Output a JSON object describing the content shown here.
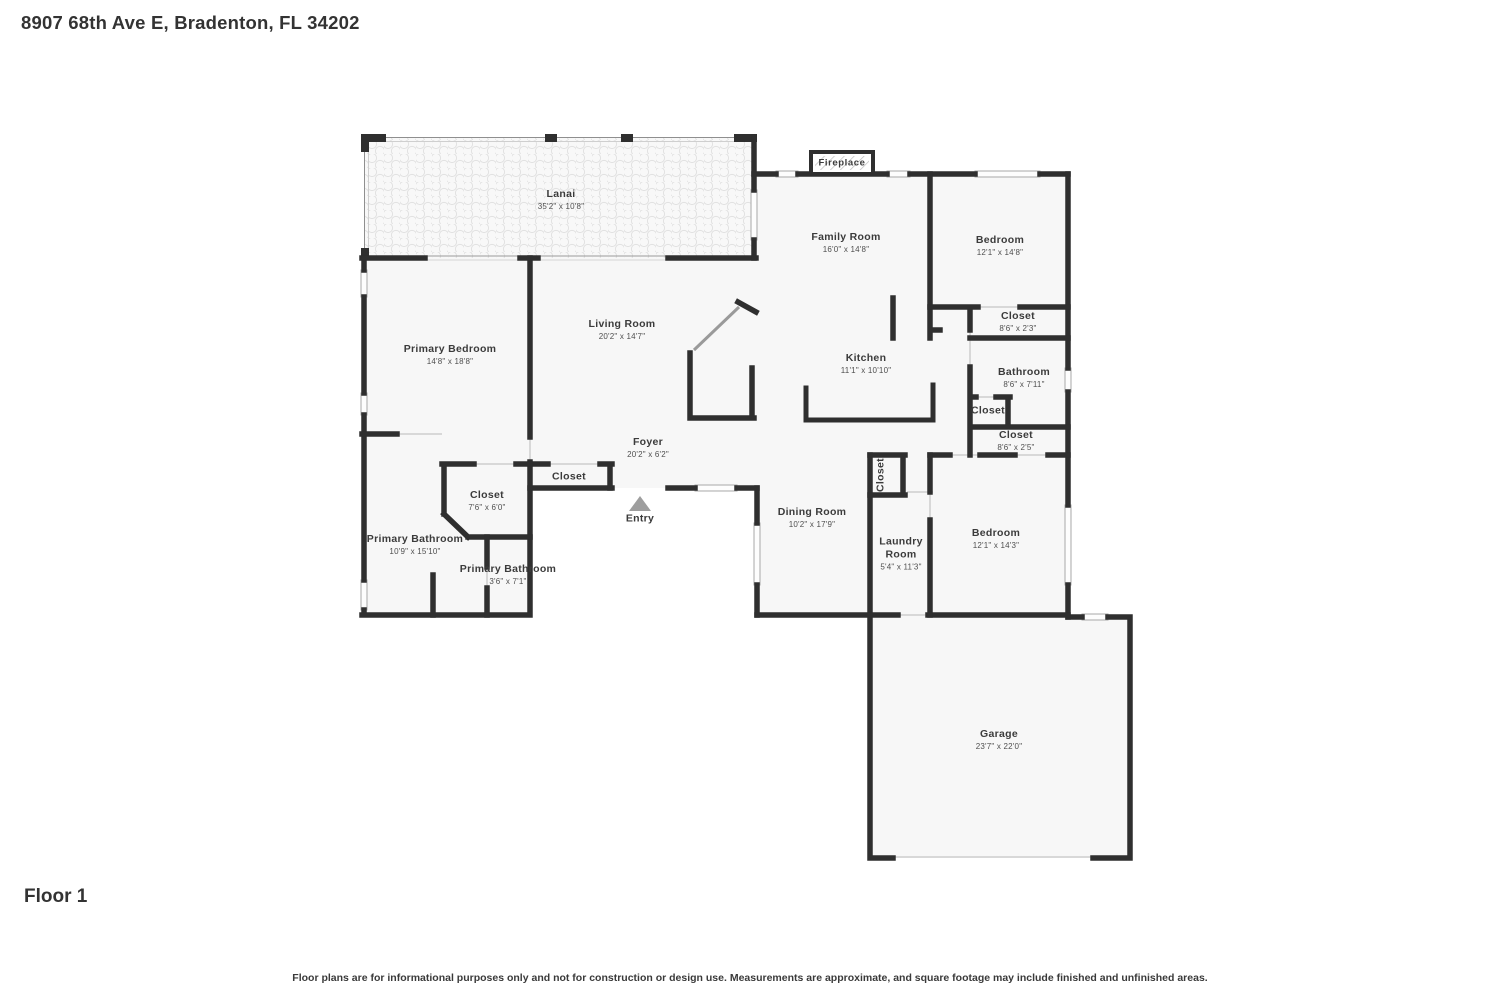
{
  "header": {
    "title": "8907 68th Ave E, Bradenton, FL 34202"
  },
  "footer": {
    "floor_label": "Floor 1",
    "disclaimer": "Floor plans are for informational purposes only and not for construction or design use. Measurements are approximate, and square footage may include finished and unfinished areas."
  },
  "floor_plan": {
    "rooms": [
      {
        "name": "Lanai",
        "dims": "35'2\" x 10'8\""
      },
      {
        "name": "Family Room",
        "dims": "16'0\" x 14'8\""
      },
      {
        "name": "Bedroom",
        "dims": "12'1\" x 14'8\""
      },
      {
        "name": "Closet",
        "dims": "8'6\" x 2'3\""
      },
      {
        "name": "Bathroom",
        "dims": "8'6\" x 7'11\""
      },
      {
        "name": "Closet",
        "dims": ""
      },
      {
        "name": "Closet",
        "dims": "8'6\" x 2'5\""
      },
      {
        "name": "Kitchen",
        "dims": "11'1\" x 10'10\""
      },
      {
        "name": "Living Room",
        "dims": "20'2\" x 14'7\""
      },
      {
        "name": "Primary Bedroom",
        "dims": "14'8\" x 18'8\""
      },
      {
        "name": "Foyer",
        "dims": "20'2\" x 6'2\""
      },
      {
        "name": "Closet",
        "dims": ""
      },
      {
        "name": "Closet",
        "dims": "7'6\" x 6'0\""
      },
      {
        "name": "Primary Bathroom",
        "dims": "10'9\" x 15'10\""
      },
      {
        "name": "Primary Bathroom",
        "dims": "3'6\" x 7'1\""
      },
      {
        "name": "Dining Room",
        "dims": "10'2\" x 17'9\""
      },
      {
        "name": "Closet",
        "dims": ""
      },
      {
        "name": "Laundry Room",
        "dims": "5'4\" x 11'3\""
      },
      {
        "name": "Bedroom",
        "dims": "12'1\" x 14'3\""
      },
      {
        "name": "Garage",
        "dims": "23'7\" x 22'0\""
      },
      {
        "name": "Fireplace",
        "dims": ""
      },
      {
        "name": "Entry",
        "dims": ""
      }
    ],
    "colors": {
      "wall": "#2f2f2f",
      "floor": "#f7f7f7",
      "window_frame": "#adadad",
      "entry_arrow": "#9e9e9e"
    }
  }
}
